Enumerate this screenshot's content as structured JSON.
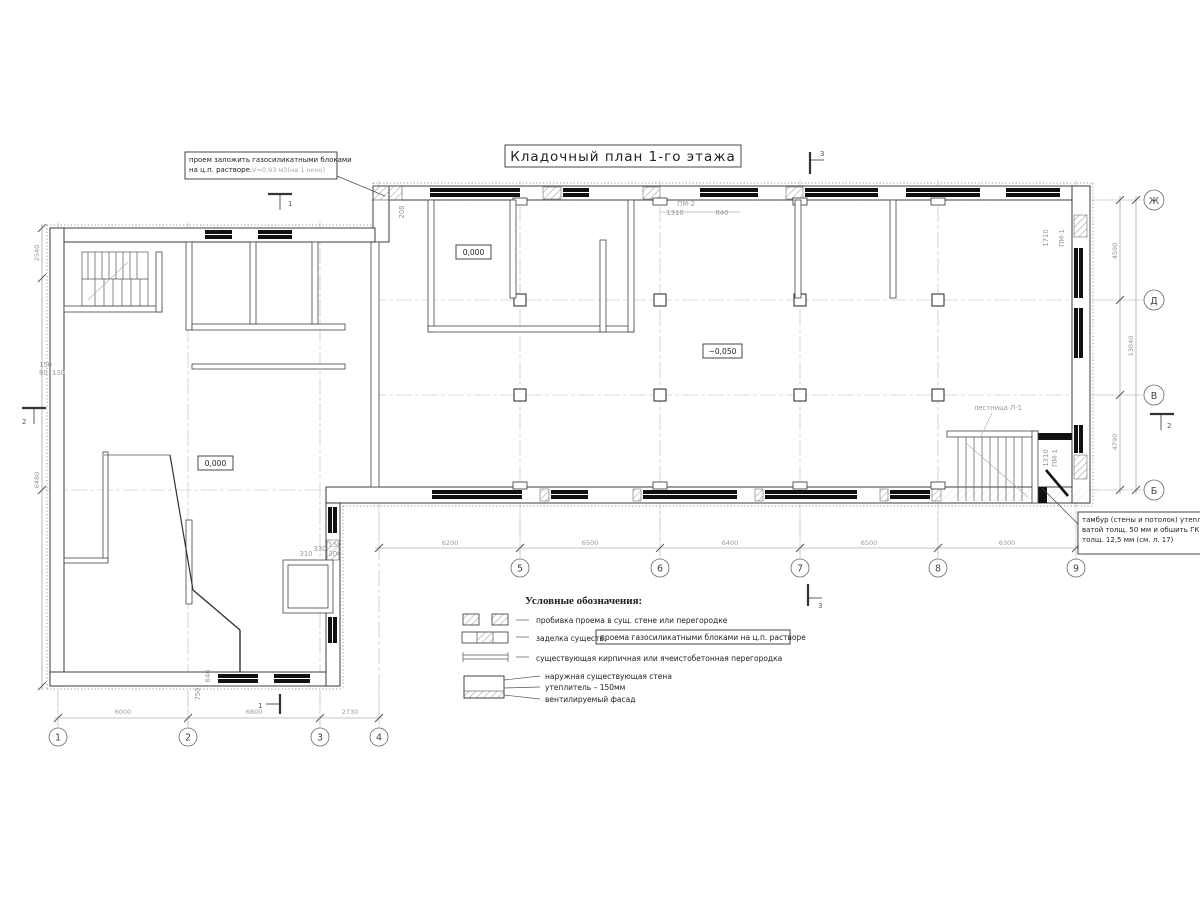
{
  "title": "Кладочный план 1-го этажа",
  "notes": {
    "opening_line1": "проем заложить газосиликатными блоками",
    "opening_line2": "на ц.п. растворе.",
    "opening_line2_gray": "V=0,93 м3(на 1 окно)",
    "tambour_line1": "тамбур (стены и потолок) утепли",
    "tambour_line2": "ватой толщ. 50 мм и обшить ГК",
    "tambour_line3": "толщ. 12,5 мм (см. л. 17)"
  },
  "labels": {
    "stair": "лестница Л-1",
    "pm2": "ПМ-2",
    "pm1_top": "ПМ-1",
    "pm1_right": "ПМ-1",
    "elev_a": "0,000",
    "elev_b": "0,000",
    "elev_c": "−0,050"
  },
  "legend": {
    "header": "Условные обозначения:",
    "row1": "пробивка проема  в сущ. стене  или перегородке",
    "row2a": "заделка существ.",
    "row2b": "проема газосиликатными блоками на ц.п. растворе",
    "row3": "существующая кирпичная или ячеистобетонная перегородка",
    "row4a": "наружная существующая стена",
    "row4b": "утеплитель – 150мм",
    "row4c": "вентилируемый фасад"
  },
  "axes": {
    "cols_left": [
      "1",
      "2",
      "3",
      "4"
    ],
    "cols_right": [
      "5",
      "6",
      "7",
      "8",
      "9"
    ],
    "rows": [
      "Ж",
      "Д",
      "В",
      "Б"
    ]
  },
  "sections": {
    "s1": "1",
    "s2": "2",
    "s3": "3"
  },
  "dims": {
    "d12": "6000",
    "d23": "6800",
    "d34": "2730",
    "d45": "6200",
    "d56": "6500",
    "d67": "6400",
    "d78": "6500",
    "d89": "6300",
    "dZhD": "4590",
    "dVB": "4790",
    "dTotalRight": "13040",
    "dLeftTop": "2540",
    "dLeftBottom": "6480",
    "pm2_d1": "1310",
    "pm2_d2": "840",
    "pm1_d": "1710",
    "pm1r_d": "1310",
    "sw150": "150",
    "sw80": "80",
    "sw130": "130",
    "sw640": "640",
    "sw750": "750",
    "sw310": "310",
    "sw330": "330",
    "sw150b": "150",
    "sw300": "300",
    "sw208": "208"
  },
  "colors": {
    "line": "#2a2a2a",
    "gray": "#9a9a9a",
    "bg": "#ffffff"
  }
}
